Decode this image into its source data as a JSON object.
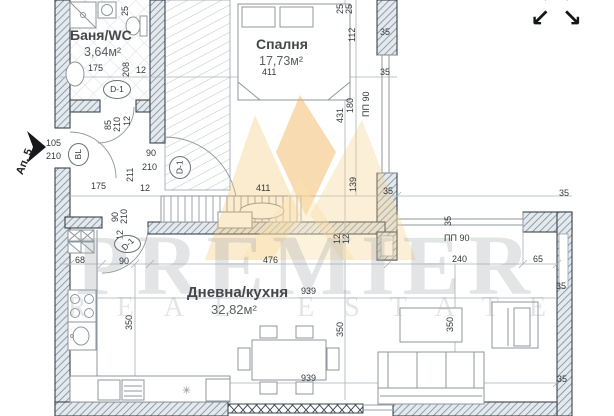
{
  "watermark": {
    "brand": "PREMIER",
    "subtitle": "REAL ESTATE",
    "gold_color": "#f0b75a",
    "gray_color": "#a0a6ac"
  },
  "entry": {
    "label": "Ап. 5",
    "door_width": "105",
    "door_height": "210"
  },
  "rooms": [
    {
      "id": "bathroom",
      "name": "Баня/WC",
      "area": "3,64м²"
    },
    {
      "id": "bedroom",
      "name": "Спалня",
      "area": "17,73м²"
    },
    {
      "id": "living",
      "name": "Дневна/кухня",
      "area": "32,82м²"
    }
  ],
  "icons": {
    "fullscreen_arrows": [
      "↖",
      "↗",
      "↙",
      "↘"
    ],
    "light_symbol": "✳"
  },
  "door_markers": [
    {
      "label": "D-1",
      "x": 103,
      "y": 80,
      "w": 28,
      "h": 19,
      "r": 0
    },
    {
      "label": "D-1",
      "x": 169,
      "y": 156,
      "w": 22,
      "h": 23,
      "r": -90
    },
    {
      "label": "D-1",
      "x": 114,
      "y": 235,
      "w": 27,
      "h": 18,
      "r": -45
    },
    {
      "label": "BL",
      "x": 68,
      "y": 143,
      "w": 21,
      "h": 23,
      "r": -90
    }
  ],
  "dimensions": [
    {
      "t": "25",
      "x": 121,
      "y": 16,
      "r": -90
    },
    {
      "t": "175",
      "x": 88,
      "y": 64,
      "r": 0
    },
    {
      "t": "208",
      "x": 122,
      "y": 77,
      "r": -90
    },
    {
      "t": "12",
      "x": 136,
      "y": 66,
      "r": 0
    },
    {
      "t": "85",
      "x": 104,
      "y": 130,
      "r": -90
    },
    {
      "t": "210",
      "x": 113,
      "y": 132,
      "r": -90
    },
    {
      "t": "12",
      "x": 123,
      "y": 126,
      "r": -90
    },
    {
      "t": "105",
      "x": 46,
      "y": 139,
      "r": 0
    },
    {
      "t": "210",
      "x": 46,
      "y": 152,
      "r": 0
    },
    {
      "t": "90",
      "x": 146,
      "y": 149,
      "r": 0
    },
    {
      "t": "210",
      "x": 142,
      "y": 163,
      "r": 0
    },
    {
      "t": "211",
      "x": 126,
      "y": 182,
      "r": -90
    },
    {
      "t": "175",
      "x": 91,
      "y": 182,
      "r": 0
    },
    {
      "t": "12",
      "x": 140,
      "y": 184,
      "r": 0
    },
    {
      "t": "411",
      "x": 256,
      "y": 184,
      "r": 0
    },
    {
      "t": "411",
      "x": 262,
      "y": 68,
      "r": 0
    },
    {
      "t": "25",
      "x": 336,
      "y": 14,
      "r": -90
    },
    {
      "t": "25",
      "x": 345,
      "y": 14,
      "r": -90
    },
    {
      "t": "112",
      "x": 348,
      "y": 42,
      "r": -90
    },
    {
      "t": "180",
      "x": 346,
      "y": 113,
      "r": -90
    },
    {
      "t": "431",
      "x": 336,
      "y": 123,
      "r": -90
    },
    {
      "t": "ПП 90",
      "x": 362,
      "y": 117,
      "r": -90
    },
    {
      "t": "139",
      "x": 349,
      "y": 192,
      "r": -90
    },
    {
      "t": "35",
      "x": 380,
      "y": 28,
      "r": 0
    },
    {
      "t": "35",
      "x": 380,
      "y": 68,
      "r": 0
    },
    {
      "t": "35",
      "x": 383,
      "y": 187,
      "r": 0
    },
    {
      "t": "12",
      "x": 333,
      "y": 244,
      "r": -90
    },
    {
      "t": "12",
      "x": 342,
      "y": 244,
      "r": -90
    },
    {
      "t": "35",
      "x": 559,
      "y": 189,
      "r": 0
    },
    {
      "t": "35",
      "x": 444,
      "y": 226,
      "r": -90
    },
    {
      "t": "ПП 90",
      "x": 444,
      "y": 234,
      "r": 0
    },
    {
      "t": "240",
      "x": 452,
      "y": 255,
      "r": 0
    },
    {
      "t": "65",
      "x": 533,
      "y": 255,
      "r": 0
    },
    {
      "t": "35",
      "x": 556,
      "y": 282,
      "r": 0
    },
    {
      "t": "90",
      "x": 111,
      "y": 222,
      "r": -90
    },
    {
      "t": "210",
      "x": 120,
      "y": 224,
      "r": -90
    },
    {
      "t": "12",
      "x": 116,
      "y": 240,
      "r": -90
    },
    {
      "t": "90",
      "x": 119,
      "y": 257,
      "r": 0
    },
    {
      "t": "68",
      "x": 75,
      "y": 256,
      "r": 0
    },
    {
      "t": "476",
      "x": 263,
      "y": 256,
      "r": 0
    },
    {
      "t": "939",
      "x": 301,
      "y": 287,
      "r": 0
    },
    {
      "t": "350",
      "x": 125,
      "y": 330,
      "r": -90
    },
    {
      "t": "350",
      "x": 336,
      "y": 337,
      "r": -90
    },
    {
      "t": "350",
      "x": 446,
      "y": 332,
      "r": -90
    },
    {
      "t": "939",
      "x": 301,
      "y": 374,
      "r": 0
    },
    {
      "t": "35",
      "x": 557,
      "y": 375,
      "r": 0
    }
  ]
}
